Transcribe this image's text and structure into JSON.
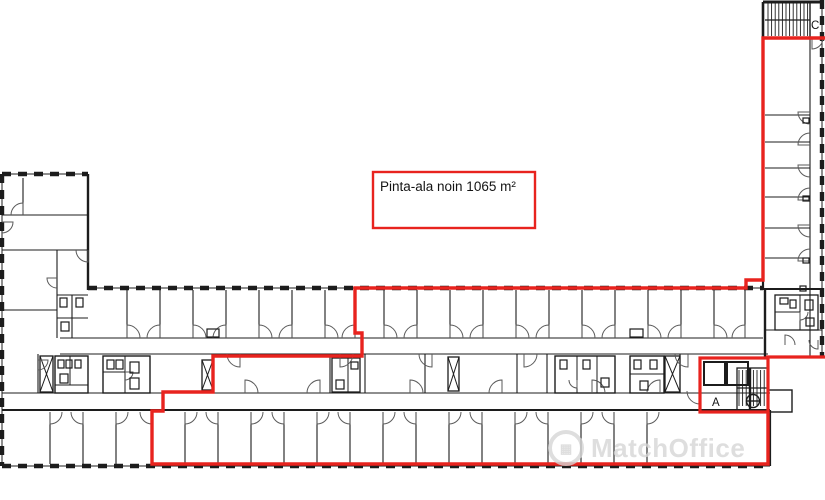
{
  "plan": {
    "area_label": "Pinta-ala noin 1065 m²",
    "stairwell_labels": {
      "a": "A",
      "c": "C"
    }
  },
  "watermark": {
    "text": "MatchOffice",
    "icon": "building-circle-icon"
  },
  "colors": {
    "outline_red": "#e8231e",
    "line_black": "#1c1c1c",
    "door_gray": "#5a5a5a",
    "watermark_gray": "#d6d6d6",
    "background": "#ffffff"
  }
}
